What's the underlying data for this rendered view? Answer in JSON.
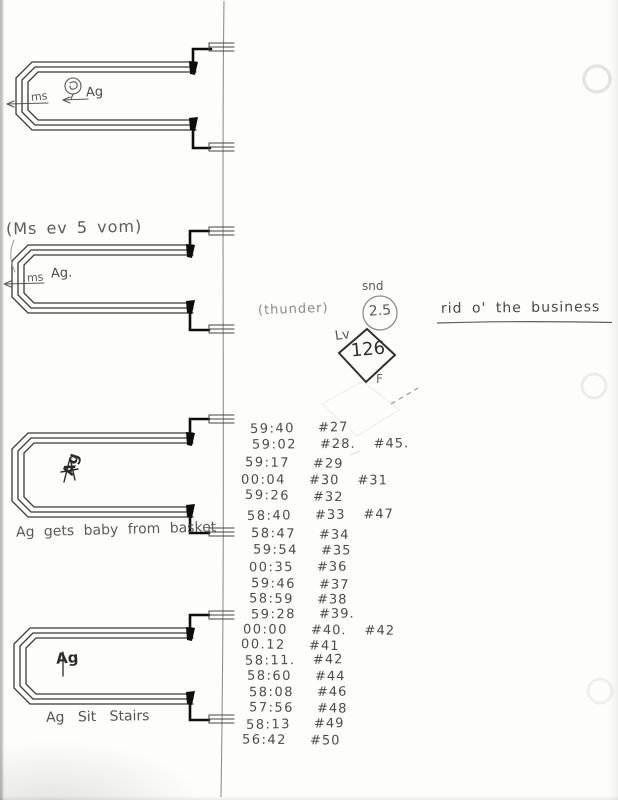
{
  "page": {
    "kind": "scanned handwritten sound-editing cue sheet",
    "ink_color": "#3a3a3a",
    "pencil_color": "#8a8a8a"
  },
  "loops": [
    {
      "track_label": "ms",
      "marker": "Ag",
      "doodle": "circled-figure",
      "caption": ""
    },
    {
      "track_label": "ms",
      "marker": "Ag.",
      "caption": "(Ms ev 5 vom)"
    },
    {
      "marker": "Ag",
      "caption": "Ag gets baby from basket"
    },
    {
      "marker": "Ag",
      "caption": "Ag Sit Stairs"
    }
  ],
  "cue": {
    "parenthetical": "(thunder)",
    "sound_label": "snd",
    "sound_number": "2.5",
    "level_label": "Lv",
    "level_number": "126",
    "below_diamond_label": "F",
    "title": "rid o' the business"
  },
  "timecodes": [
    {
      "time": "59:40",
      "tags": [
        "#27"
      ]
    },
    {
      "time": "59:02",
      "tags": [
        "#28.",
        "#45."
      ]
    },
    {
      "time": "59:17",
      "tags": [
        "#29"
      ]
    },
    {
      "time": "00:04",
      "tags": [
        "#30",
        "#31"
      ]
    },
    {
      "time": "59:26",
      "tags": [
        "#32"
      ]
    },
    {
      "time": "58:40",
      "tags": [
        "#33",
        "#47"
      ]
    },
    {
      "time": "58:47",
      "tags": [
        "#34"
      ]
    },
    {
      "time": "59:54",
      "tags": [
        "#35"
      ]
    },
    {
      "time": "00:35",
      "tags": [
        "#36"
      ]
    },
    {
      "time": "59:46",
      "tags": [
        "#37"
      ]
    },
    {
      "time": "58:59",
      "tags": [
        "#38"
      ]
    },
    {
      "time": "59:28",
      "tags": [
        "#39."
      ]
    },
    {
      "time": "00:00",
      "tags": [
        "#40.",
        "#42"
      ]
    },
    {
      "time": "00.12",
      "tags": [
        "#41"
      ]
    },
    {
      "time": "58:11.",
      "tags": [
        "#42"
      ]
    },
    {
      "time": "58:60",
      "tags": [
        "#44"
      ]
    },
    {
      "time": "58:08",
      "tags": [
        "#46"
      ]
    },
    {
      "time": "57:56",
      "tags": [
        "#48"
      ]
    },
    {
      "time": "58:13",
      "tags": [
        "#49"
      ]
    },
    {
      "time": "56:42",
      "tags": [
        "#50"
      ]
    }
  ]
}
